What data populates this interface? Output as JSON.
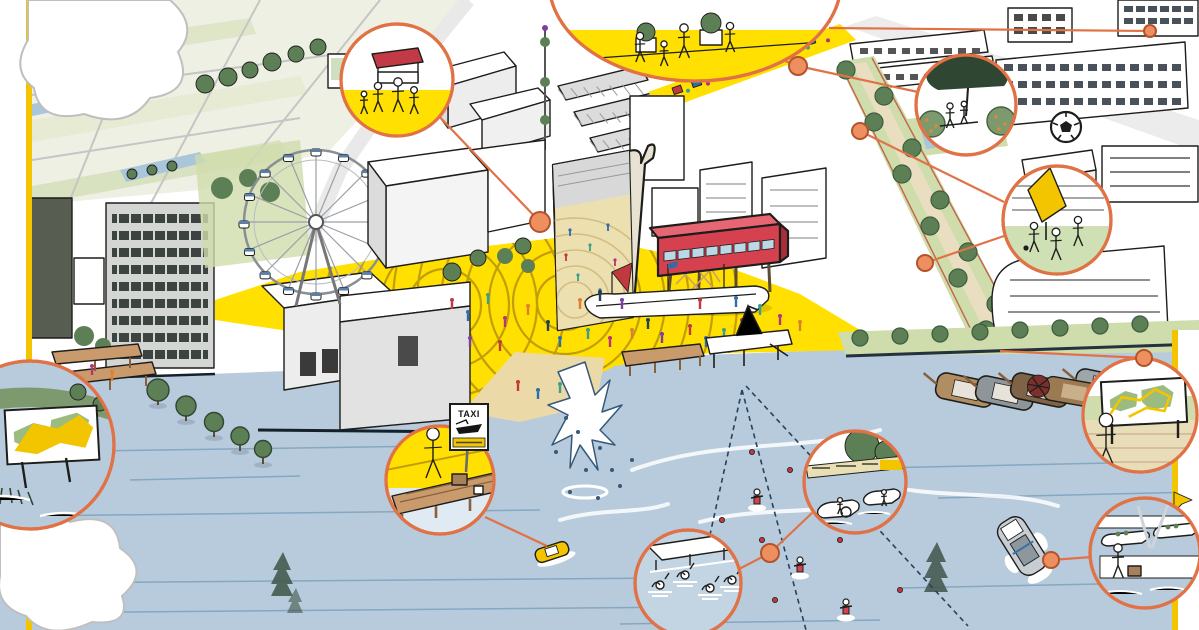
{
  "title": "Waterfront district masterplan - illustrated aerial view",
  "signs": {
    "taxi": {
      "label": "TAXI"
    }
  },
  "callouts": [
    {
      "id": "street-market",
      "scene": "market-stall-with-red-awning"
    },
    {
      "id": "community-gardening",
      "scene": "planters-on-yellow-promenade"
    },
    {
      "id": "picnic-orchard",
      "scene": "seated-couple-under-tree-with-fruit-bushes"
    },
    {
      "id": "play-running",
      "scene": "children-running-past-yellow-canopy"
    },
    {
      "id": "route-map-sign",
      "scene": "wayfinding-board-with-yellow-route"
    },
    {
      "id": "water-taxi-stop",
      "scene": "traveller-with-suitcase-on-jetty"
    },
    {
      "id": "harbour-swimming",
      "scene": "swimmers-in-harbour-pool"
    },
    {
      "id": "pedal-boats",
      "scene": "pedal-boats-along-green-bank"
    },
    {
      "id": "jogging-route",
      "scene": "jogger-passing-route-map"
    },
    {
      "id": "ferry-terminal",
      "scene": "passenger-with-luggage-at-pier"
    }
  ],
  "landmarks": [
    "farm-fields",
    "ferris-wheel",
    "event-banner",
    "red-viewing-pavilion",
    "yellow-event-plaza",
    "playground-ship",
    "market-street",
    "campus-buildings",
    "tree-lined-park-path",
    "waterfront-towers",
    "harbour-fountain",
    "swimming-pier",
    "cable-ski-course",
    "mangrove-trees",
    "moored-heritage-boats",
    "water-taxi-boat",
    "speed-boat",
    "soccer-ball",
    "clouds"
  ],
  "colors": {
    "ink": "#1d1d1b",
    "water": "#b7cbdc",
    "water_line": "#86a7c0",
    "plaza_yellow": "#ffe000",
    "plaza_arc": "#c19d08",
    "lawn_green": "#cfdcab",
    "tree_green": "#5d7f55",
    "tree_dark": "#3d5c40",
    "callout_orange": "#e07246",
    "dot_fill": "#ee8f60",
    "dot_stroke": "#b4532b",
    "pavilion_red": "#d6414f",
    "wood": "#c99a6b",
    "frame_yellow": "#f2c500",
    "sand": "#ecd9a8",
    "canal_blue": "#a9c6db",
    "field_green": "#dfe6c8",
    "cloud_outline": "#bfbfbf",
    "gondola_blue": "#5b7fa6"
  }
}
